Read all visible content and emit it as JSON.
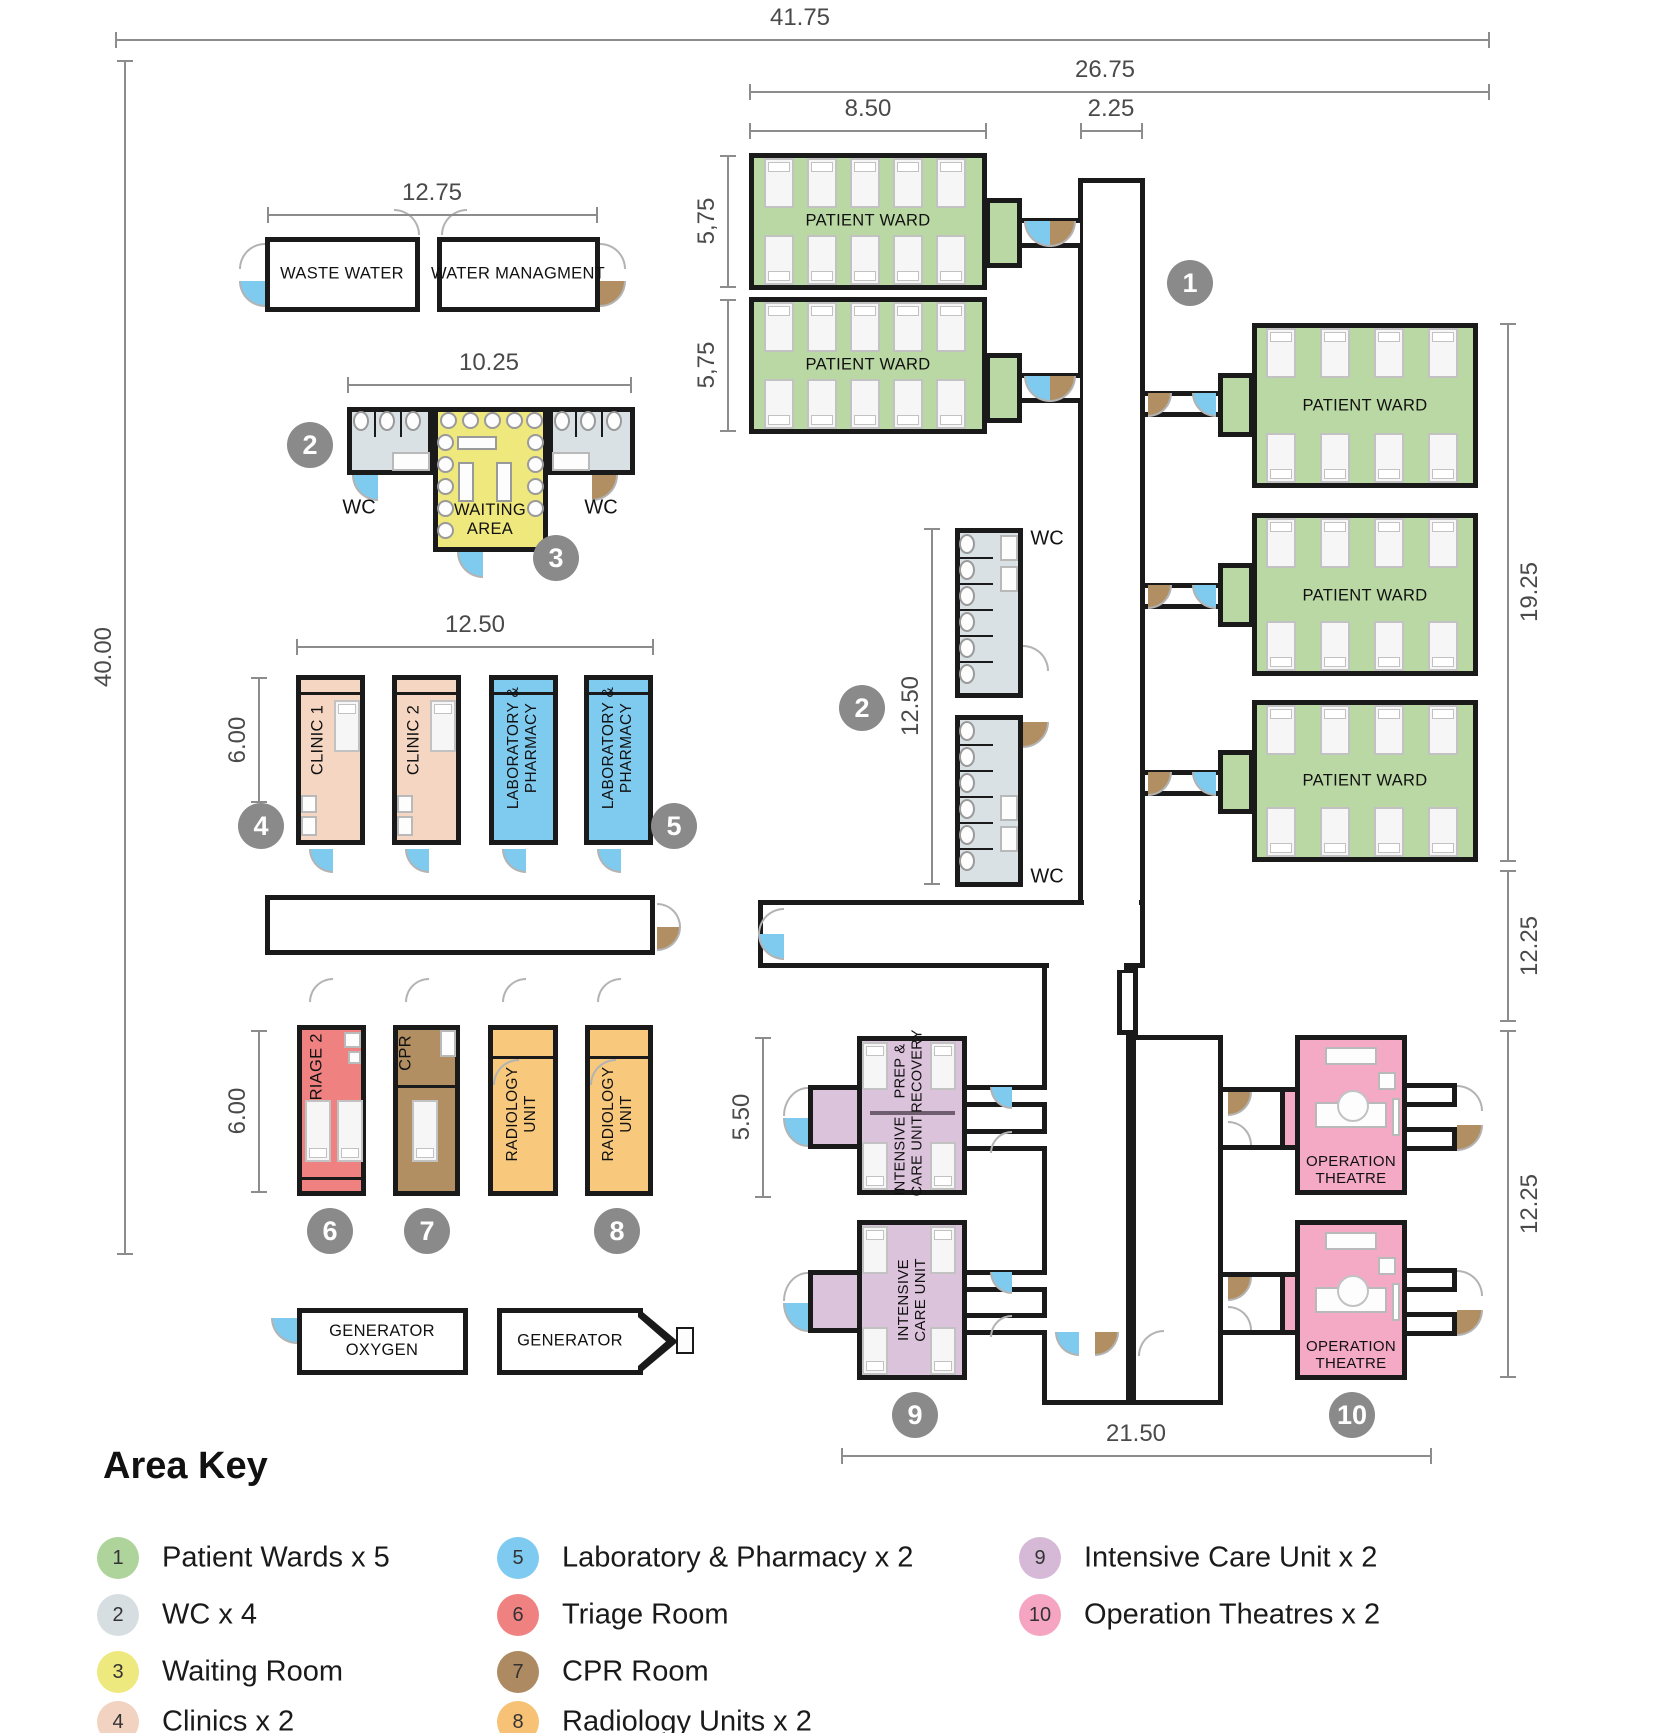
{
  "plan": {
    "dims": {
      "total_width": "41.75",
      "total_height": "40.00",
      "right_block_width": "26.75",
      "ward_width": "8.50",
      "corridor_width": "2.25",
      "utility_width": "12.75",
      "wc_waiting_width": "10.25",
      "ward_a_height": "5,75",
      "ward_b_height": "5,75",
      "right_wards_height": "19.25",
      "mid_right_height": "12.25",
      "theatre_block_height": "12.25",
      "clinic_block_width": "12.50",
      "clinic_height": "6.00",
      "mid_wc_height": "12.50",
      "triage_height": "6.00",
      "icu_height": "5.50",
      "bottom_block_width": "21.50"
    },
    "rooms": {
      "waste_water": "WASTE WATER",
      "water_management": "WATER MANAGMENT",
      "wc": "WC",
      "waiting_area": "WAITING\nAREA",
      "patient_ward": "PATIENT WARD",
      "clinic_1": "CLINIC 1",
      "clinic_2": "CLINIC 2",
      "laboratory": "LABORATORY &\nPHARMACY",
      "triage": "TRIAGE 2",
      "cpr": "CPR",
      "radiology": "RADIOLOGY\nUNIT",
      "prep_recovery": "PREP &\nRECOVERY",
      "intensive_care": "INTENSIVE\nCARE UNIT",
      "operation_theatre": "OPERATION\nTHEATRE",
      "generator_oxygen": "GENERATOR\nOXYGEN",
      "generator": "GENERATOR"
    },
    "markers": {
      "m1": "1",
      "m2": "2",
      "m3": "3",
      "m4": "4",
      "m5": "5",
      "m6": "6",
      "m7": "7",
      "m8": "8",
      "m9": "9",
      "m10": "10"
    }
  },
  "legend": {
    "title": "Area Key",
    "items": [
      {
        "num": "1",
        "label": "Patient Wards x 5",
        "color": "#aed49b"
      },
      {
        "num": "2",
        "label": "WC x 4",
        "color": "#d7dee2"
      },
      {
        "num": "3",
        "label": "Waiting Room",
        "color": "#eee97e"
      },
      {
        "num": "4",
        "label": "Clinics x 2",
        "color": "#f2d2c0"
      },
      {
        "num": "5",
        "label": "Laboratory & Pharmacy x 2",
        "color": "#7ecaf0"
      },
      {
        "num": "6",
        "label": "Triage Room",
        "color": "#f08181"
      },
      {
        "num": "7",
        "label": "CPR Room",
        "color": "#ad8a61"
      },
      {
        "num": "8",
        "label": "Radiology Units x 2",
        "color": "#f7c276"
      },
      {
        "num": "9",
        "label": "Intensive Care Unit x 2",
        "color": "#d5b9d6"
      },
      {
        "num": "10",
        "label": "Operation Theatres x 2",
        "color": "#f5a5c2"
      }
    ]
  },
  "colors": {
    "ward_green": "#b9d8a3",
    "wc_gray": "#dae1e4",
    "waiting_yellow": "#efe87d",
    "clinic_tan": "#f4d6c2",
    "lab_blue": "#7fcbf0",
    "triage_red": "#ef8181",
    "cpr_brown": "#b18f63",
    "radiology_orange": "#f8c97c",
    "icu_purple": "#dcc3dc",
    "theatre_pink": "#f4a9c5",
    "marker_gray": "#8a8a8a",
    "wall": "#1a1a1a"
  }
}
